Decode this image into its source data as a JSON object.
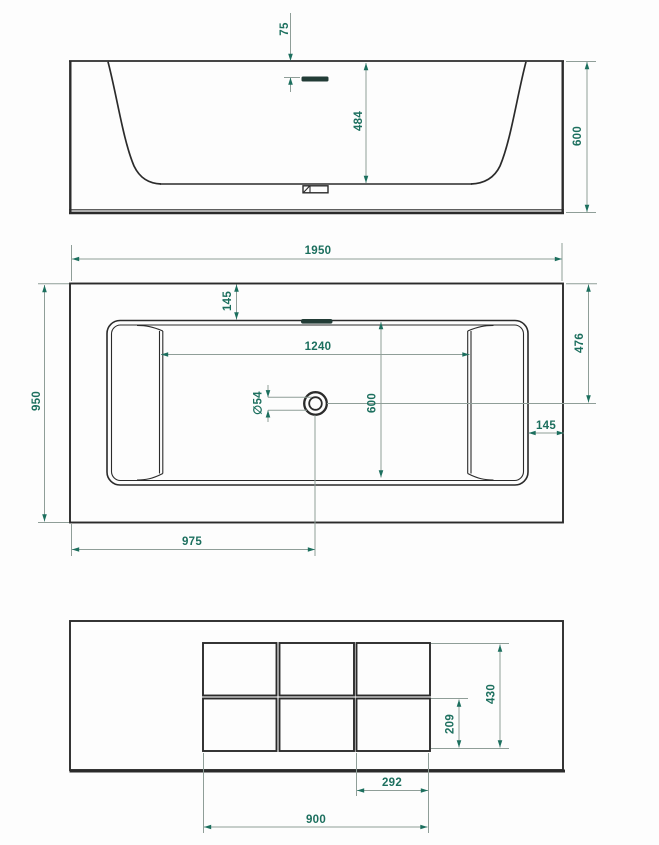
{
  "drawing": {
    "subject": "bathtub-technical-drawing",
    "units": "mm",
    "colors": {
      "geometry_line": "#2b2b2b",
      "dimension_line": "#8f9e98",
      "accent_text": "#1c6f5e",
      "background": "#fdfdfd"
    },
    "views": {
      "front_elevation": {
        "dims": {
          "rim_to_overflow": "75",
          "basin_depth": "484",
          "overall_height": "600"
        }
      },
      "plan": {
        "dims": {
          "overall_length": "1950",
          "rim_border_top": "145",
          "basin_floor_length": "1240",
          "drain_diameter": "∅54",
          "basin_width": "600",
          "drain_offset_from_top": "476",
          "rim_border_right": "145",
          "overall_width": "950",
          "drain_offset_from_left": "975"
        }
      },
      "bottom": {
        "dims": {
          "pad_field_depth": "430",
          "pad_depth": "209",
          "pad_width": "292",
          "pad_field_length": "900"
        }
      }
    }
  }
}
